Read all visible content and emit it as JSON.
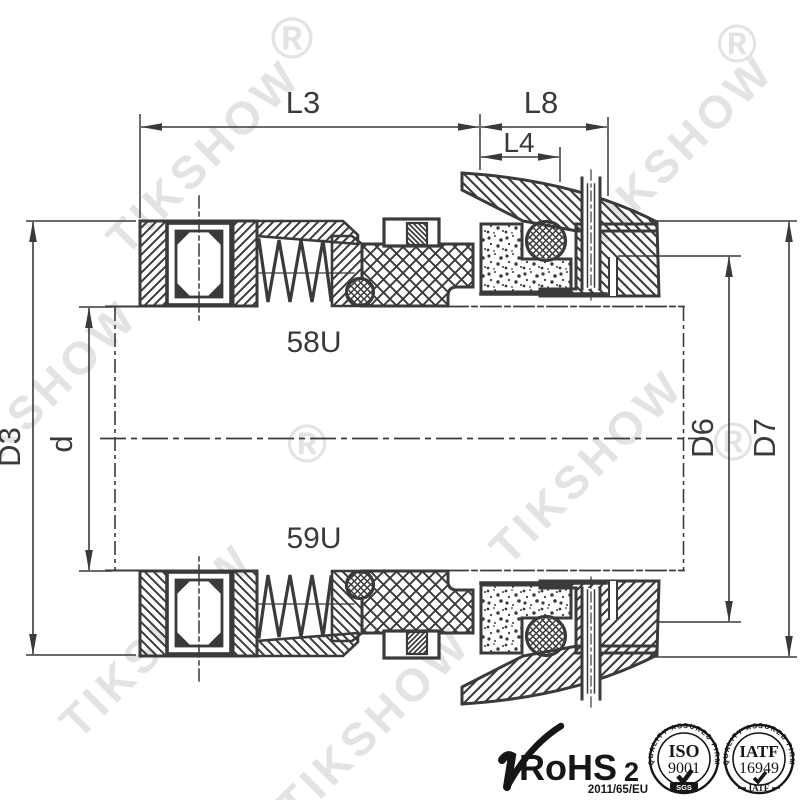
{
  "drawing": {
    "dim_labels": {
      "l3": "L3",
      "l8": "L8",
      "l4": "L4",
      "d3": "D3",
      "d": "d",
      "d6": "D6",
      "d7": "D7"
    },
    "part_labels": {
      "top": "58U",
      "bottom": "59U"
    }
  },
  "watermark": {
    "text": "TIKSHOW",
    "registered": "®"
  },
  "certifications": {
    "rohs": {
      "name": "RoHS",
      "suffix": "2",
      "directive": "2011/65/EU"
    },
    "iso9001": {
      "arc": "QUALITY ASSURED FIRM",
      "org": "ISO",
      "number": "9001",
      "footer": "SGS"
    },
    "iatf16949": {
      "arc": "QUALITY ASSURED FIRM",
      "org": "IATF",
      "number": "16949",
      "footer": "IATF"
    }
  },
  "colors": {
    "line": "#3a3a3a",
    "watermark": "#e3e3e3",
    "logo": "#161616",
    "background": "#ffffff"
  }
}
